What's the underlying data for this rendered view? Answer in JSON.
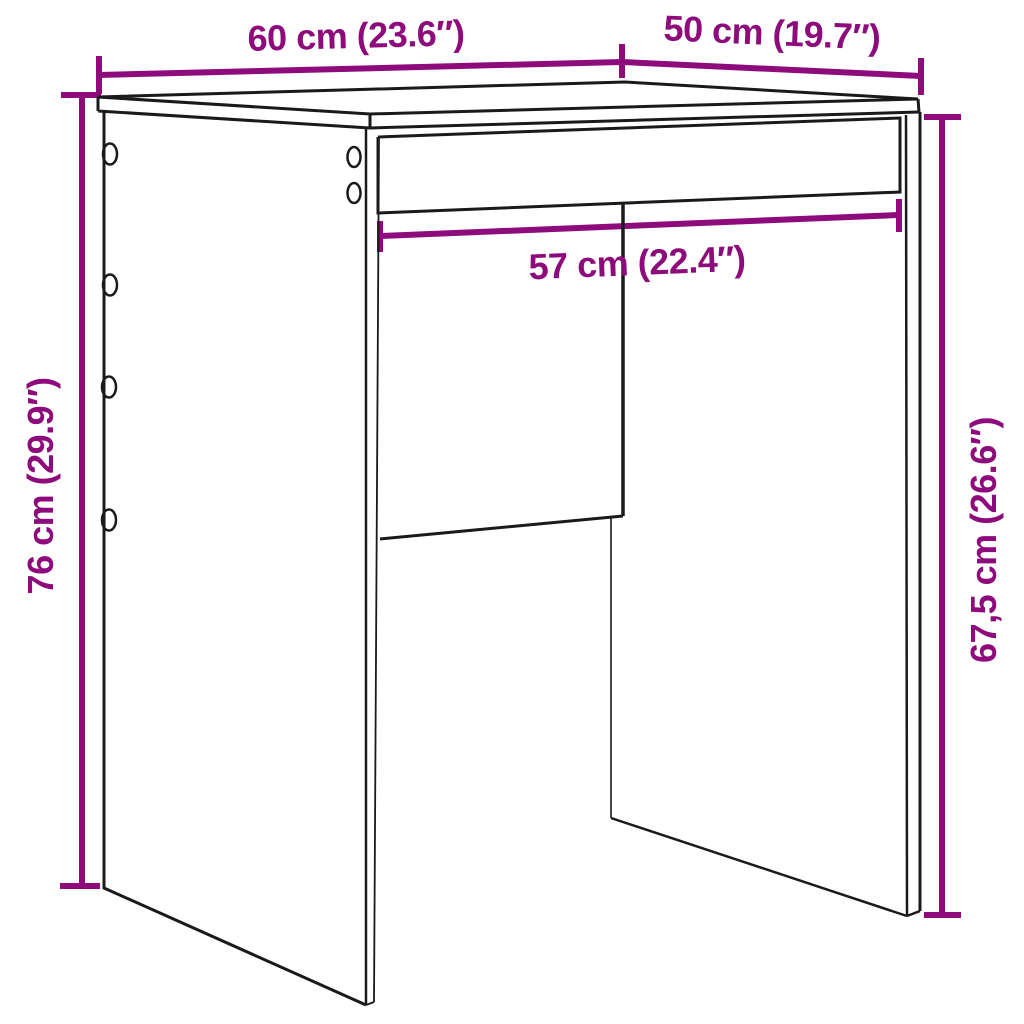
{
  "page": {
    "title": "Furniture dimension diagram",
    "background": "#ffffff"
  },
  "colors": {
    "accent": "#8d0b7a",
    "line": "#1a1a1a"
  },
  "diagram": {
    "kind": "product-dimension-line-drawing",
    "product": "desk / side table with tabletop, front apron, two side panels and half-height back panel, assembly holes on left panel",
    "dimensions": [
      {
        "id": "width",
        "label": "60 cm (23.6″)",
        "value_cm": 60,
        "value_in": 23.6,
        "edge": "tabletop width (top left edge)"
      },
      {
        "id": "depth",
        "label": "50 cm (19.7″)",
        "value_cm": 50,
        "value_in": 19.7,
        "edge": "tabletop depth (top right edge)"
      },
      {
        "id": "inner-width",
        "label": "57 cm (22.4″)",
        "value_cm": 57,
        "value_in": 22.4,
        "edge": "inner clearance width below apron"
      },
      {
        "id": "height",
        "label": "76 cm (29.9″)",
        "value_cm": 76,
        "value_in": 29.9,
        "edge": "total height (left side)"
      },
      {
        "id": "clearance-height",
        "label": "67,5 cm (26.6″)",
        "value_cm": 67.5,
        "value_in": 26.6,
        "edge": "clearance height under tabletop (right side)"
      }
    ]
  }
}
